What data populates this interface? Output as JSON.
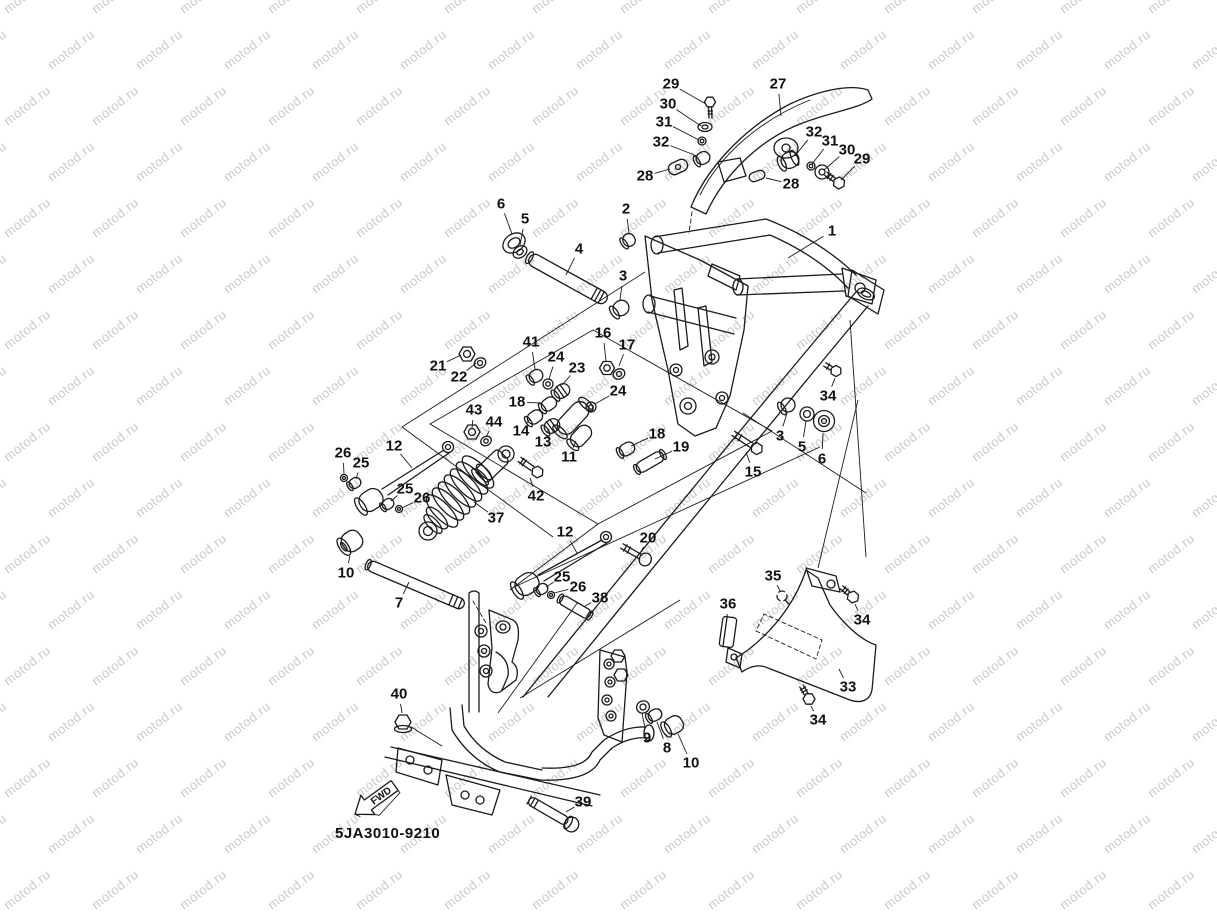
{
  "watermark": {
    "text": "motod.ru",
    "color": "#c9c9c9",
    "rotation": -38,
    "x_step": 88,
    "y_step": 56,
    "row_offset": 44
  },
  "page": {
    "background": "#ffffff",
    "line_color": "#1a1a1a"
  },
  "diagram": {
    "code": "5JA3010-9210",
    "fwd_label": "FWD",
    "callouts": [
      {
        "id": "29a",
        "n": "29",
        "x": 671,
        "y": 84,
        "tx": 706,
        "ty": 104
      },
      {
        "id": "30a",
        "n": "30",
        "x": 668,
        "y": 104,
        "tx": 701,
        "ty": 126
      },
      {
        "id": "31a",
        "n": "31",
        "x": 664,
        "y": 122,
        "tx": 699,
        "ty": 140
      },
      {
        "id": "32a",
        "n": "32",
        "x": 661,
        "y": 142,
        "tx": 697,
        "ty": 156
      },
      {
        "id": "28a",
        "n": "28",
        "x": 645,
        "y": 176,
        "tx": 670,
        "ty": 169
      },
      {
        "id": "27",
        "n": "27",
        "x": 778,
        "y": 84,
        "tx": 781,
        "ty": 116
      },
      {
        "id": "32b",
        "n": "32",
        "x": 814,
        "y": 132,
        "tx": 795,
        "ty": 156
      },
      {
        "id": "31b",
        "n": "31",
        "x": 830,
        "y": 141,
        "tx": 812,
        "ty": 164
      },
      {
        "id": "30b",
        "n": "30",
        "x": 847,
        "y": 150,
        "tx": 824,
        "ty": 170
      },
      {
        "id": "29b",
        "n": "29",
        "x": 862,
        "y": 159,
        "tx": 841,
        "ty": 180
      },
      {
        "id": "28b",
        "n": "28",
        "x": 791,
        "y": 184,
        "tx": 766,
        "ty": 178
      },
      {
        "id": "2",
        "n": "2",
        "x": 626,
        "y": 209,
        "tx": 629,
        "ty": 233
      },
      {
        "id": "1",
        "n": "1",
        "x": 832,
        "y": 231,
        "tx": 788,
        "ty": 258
      },
      {
        "id": "6a",
        "n": "6",
        "x": 501,
        "y": 204,
        "tx": 512,
        "ty": 234
      },
      {
        "id": "5a",
        "n": "5",
        "x": 525,
        "y": 219,
        "tx": 520,
        "ty": 245
      },
      {
        "id": "4",
        "n": "4",
        "x": 579,
        "y": 249,
        "tx": 566,
        "ty": 275
      },
      {
        "id": "3a",
        "n": "3",
        "x": 623,
        "y": 276,
        "tx": 620,
        "ty": 300
      },
      {
        "id": "16",
        "n": "16",
        "x": 603,
        "y": 333,
        "tx": 606,
        "ty": 361
      },
      {
        "id": "17",
        "n": "17",
        "x": 627,
        "y": 345,
        "tx": 619,
        "ty": 366
      },
      {
        "id": "41",
        "n": "41",
        "x": 531,
        "y": 342,
        "tx": 535,
        "ty": 369
      },
      {
        "id": "24a",
        "n": "24",
        "x": 556,
        "y": 357,
        "tx": 549,
        "ty": 379
      },
      {
        "id": "23",
        "n": "23",
        "x": 577,
        "y": 368,
        "tx": 562,
        "ty": 385
      },
      {
        "id": "21",
        "n": "21",
        "x": 438,
        "y": 366,
        "tx": 461,
        "ty": 355
      },
      {
        "id": "22",
        "n": "22",
        "x": 459,
        "y": 377,
        "tx": 476,
        "ty": 363
      },
      {
        "id": "18a",
        "n": "18",
        "x": 517,
        "y": 402,
        "tx": 541,
        "ty": 403
      },
      {
        "id": "24b",
        "n": "24",
        "x": 618,
        "y": 391,
        "tx": 595,
        "ty": 404
      },
      {
        "id": "43",
        "n": "43",
        "x": 474,
        "y": 410,
        "tx": 472,
        "ty": 428
      },
      {
        "id": "44",
        "n": "44",
        "x": 494,
        "y": 422,
        "tx": 486,
        "ty": 437
      },
      {
        "id": "14",
        "n": "14",
        "x": 521,
        "y": 431,
        "tx": 530,
        "ty": 419
      },
      {
        "id": "13",
        "n": "13",
        "x": 543,
        "y": 442,
        "tx": 549,
        "ty": 429
      },
      {
        "id": "11",
        "n": "11",
        "x": 569,
        "y": 457,
        "tx": 576,
        "ty": 441
      },
      {
        "id": "18b",
        "n": "18",
        "x": 657,
        "y": 434,
        "tx": 631,
        "ty": 446
      },
      {
        "id": "19",
        "n": "19",
        "x": 681,
        "y": 447,
        "tx": 655,
        "ty": 459
      },
      {
        "id": "26a",
        "n": "26",
        "x": 343,
        "y": 453,
        "tx": 344,
        "ty": 474
      },
      {
        "id": "25a",
        "n": "25",
        "x": 361,
        "y": 463,
        "tx": 356,
        "ty": 479
      },
      {
        "id": "12a",
        "n": "12",
        "x": 394,
        "y": 446,
        "tx": 412,
        "ty": 468
      },
      {
        "id": "25b",
        "n": "25",
        "x": 405,
        "y": 489,
        "tx": 391,
        "ty": 501
      },
      {
        "id": "26b",
        "n": "26",
        "x": 422,
        "y": 498,
        "tx": 402,
        "ty": 508
      },
      {
        "id": "37",
        "n": "37",
        "x": 496,
        "y": 518,
        "tx": 474,
        "ty": 502
      },
      {
        "id": "42",
        "n": "42",
        "x": 536,
        "y": 496,
        "tx": 530,
        "ty": 478
      },
      {
        "id": "12b",
        "n": "12",
        "x": 565,
        "y": 532,
        "tx": 577,
        "ty": 553
      },
      {
        "id": "20",
        "n": "20",
        "x": 648,
        "y": 538,
        "tx": 641,
        "ty": 552
      },
      {
        "id": "25c",
        "n": "25",
        "x": 562,
        "y": 577,
        "tx": 546,
        "ty": 587
      },
      {
        "id": "26c",
        "n": "26",
        "x": 578,
        "y": 587,
        "tx": 554,
        "ty": 593
      },
      {
        "id": "38",
        "n": "38",
        "x": 600,
        "y": 598,
        "tx": 585,
        "ty": 606
      },
      {
        "id": "10a",
        "n": "10",
        "x": 346,
        "y": 573,
        "tx": 350,
        "ty": 556
      },
      {
        "id": "7",
        "n": "7",
        "x": 399,
        "y": 603,
        "tx": 409,
        "ty": 582
      },
      {
        "id": "40",
        "n": "40",
        "x": 399,
        "y": 694,
        "tx": 402,
        "ty": 713
      },
      {
        "id": "9",
        "n": "9",
        "x": 647,
        "y": 738,
        "tx": 642,
        "ty": 713
      },
      {
        "id": "8",
        "n": "8",
        "x": 667,
        "y": 748,
        "tx": 657,
        "ty": 722
      },
      {
        "id": "10b",
        "n": "10",
        "x": 691,
        "y": 763,
        "tx": 678,
        "ty": 734
      },
      {
        "id": "39",
        "n": "39",
        "x": 583,
        "y": 802,
        "tx": 566,
        "ty": 812
      },
      {
        "id": "35",
        "n": "35",
        "x": 773,
        "y": 576,
        "tx": 780,
        "ty": 591
      },
      {
        "id": "36",
        "n": "36",
        "x": 728,
        "y": 604,
        "tx": 727,
        "ty": 617
      },
      {
        "id": "34a",
        "n": "34",
        "x": 862,
        "y": 620,
        "tx": 855,
        "ty": 604
      },
      {
        "id": "33",
        "n": "33",
        "x": 848,
        "y": 687,
        "tx": 839,
        "ty": 669
      },
      {
        "id": "34b",
        "n": "34",
        "x": 818,
        "y": 720,
        "tx": 811,
        "ty": 706
      },
      {
        "id": "34c",
        "n": "34",
        "x": 828,
        "y": 396,
        "tx": 835,
        "ty": 378
      },
      {
        "id": "3b",
        "n": "3",
        "x": 780,
        "y": 436,
        "tx": 787,
        "ty": 413
      },
      {
        "id": "5b",
        "n": "5",
        "x": 802,
        "y": 447,
        "tx": 806,
        "ty": 421
      },
      {
        "id": "6b",
        "n": "6",
        "x": 822,
        "y": 459,
        "tx": 823,
        "ty": 433
      },
      {
        "id": "15",
        "n": "15",
        "x": 753,
        "y": 472,
        "tx": 746,
        "ty": 452
      }
    ]
  }
}
